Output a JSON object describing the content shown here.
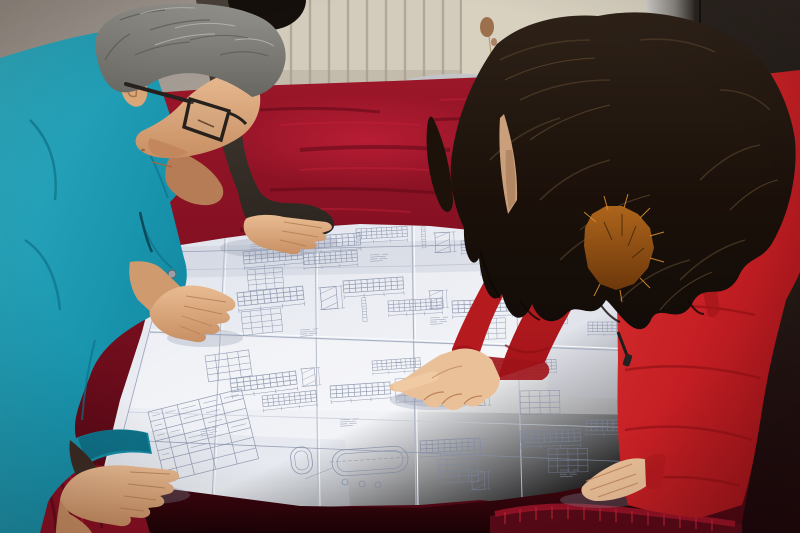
{
  "scene": {
    "kind": "photograph",
    "caption": "Two workers leaning over a large folded engineering blueprint spread on a red velvet covered table",
    "people": [
      {
        "id": "man-engineer",
        "label": "older man, gray hair, dark glasses, teal work jacket, leaning over drawing"
      },
      {
        "id": "colleague-behind",
        "label": "person in dark jacket standing behind the man, hand resting on drawing"
      },
      {
        "id": "woman-red-coat",
        "label": "woman with long dark hair, red padded coat with orange fur-trimmed hood, pointing at drawing"
      }
    ],
    "objects": [
      {
        "id": "blueprint",
        "label": "large folded white technical drawing with elevation details, schedule table and obround flange detail"
      },
      {
        "id": "velvet-tablecloth",
        "label": "crimson velvet table cover"
      },
      {
        "id": "radiator",
        "label": "cream wall radiator with vertical slats"
      },
      {
        "id": "stained-wall",
        "label": "cream wall with rust stains"
      },
      {
        "id": "door-panel",
        "label": "dark door panel at right"
      },
      {
        "id": "chair-back",
        "label": "metal tube chair back behind table"
      }
    ],
    "palette": {
      "teal_jacket": "#1d9cb4",
      "red_coat": "#c92327",
      "fur_trim": "#b2651c",
      "velvet_bright": "#96152b",
      "velvet_dark": "#3c060f",
      "paper": "#e9ecf2",
      "drawing_ink": "#7c87a2",
      "radiator": "#d3ccbd",
      "door": "#1f1a16",
      "hair_gray": "#85847e",
      "hair_dark": "#1c140e"
    }
  }
}
